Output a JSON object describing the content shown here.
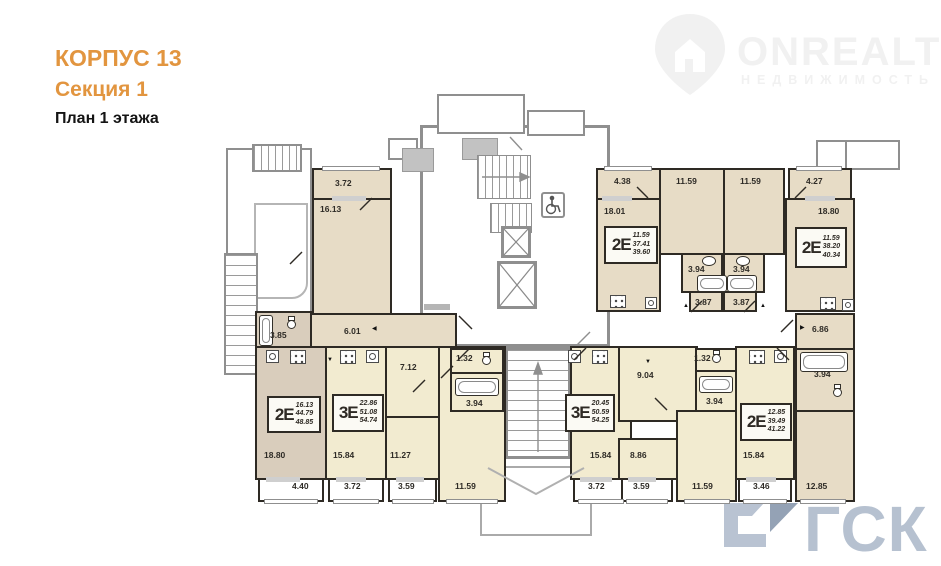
{
  "header": {
    "building": "КОРПУС 13",
    "section": "Секция 1",
    "plan": "План 1 этажа"
  },
  "watermarks": {
    "onrealt_name": "ONREALT",
    "onrealt_sub": "НЕДВИЖИМОСТЬ",
    "gsk": "ГСК"
  },
  "colors": {
    "title_accent": "#e2953f",
    "apartment_beige": "#e7dcc6",
    "apartment_taupe": "#d9cdbc",
    "apartment_cream": "#f2ebd0",
    "wall_dark": "#2e2a24",
    "wall_gray": "#8f8f8f",
    "gsk_watermark": "#b6c1d0"
  },
  "plan": {
    "apartments": [
      {
        "type": "2Е",
        "living": "11.59",
        "area": "37.41",
        "total": "39.60"
      },
      {
        "type": "2Е",
        "living": "11.59",
        "area": "38.20",
        "total": "40.34"
      },
      {
        "type": "2Е",
        "living": "16.13",
        "area": "44.79",
        "total": "48.85"
      },
      {
        "type": "3Е",
        "living": "22.86",
        "area": "51.08",
        "total": "54.74"
      },
      {
        "type": "3Е",
        "living": "20.45",
        "area": "50.59",
        "total": "54.25"
      },
      {
        "type": "2Е",
        "living": "12.85",
        "area": "39.49",
        "total": "41.22"
      }
    ],
    "areas": [
      {
        "room": "balcony",
        "value": "3.72"
      },
      {
        "room": "room",
        "value": "16.13"
      },
      {
        "room": "balcony",
        "value": "4.38"
      },
      {
        "room": "room",
        "value": "18.01"
      },
      {
        "room": "room",
        "value": "11.59"
      },
      {
        "room": "room",
        "value": "11.59"
      },
      {
        "room": "balcony",
        "value": "4.27"
      },
      {
        "room": "room",
        "value": "18.80"
      },
      {
        "room": "bath",
        "value": "3.94"
      },
      {
        "room": "bath",
        "value": "3.94"
      },
      {
        "room": "hall",
        "value": "3.87"
      },
      {
        "room": "hall",
        "value": "3.87"
      },
      {
        "room": "bath",
        "value": "3.85"
      },
      {
        "room": "hall",
        "value": "6.01"
      },
      {
        "room": "hall",
        "value": "6.86"
      },
      {
        "room": "hall",
        "value": "7.12"
      },
      {
        "room": "wc",
        "value": "1.32"
      },
      {
        "room": "bath",
        "value": "3.94"
      },
      {
        "room": "hall",
        "value": "9.04"
      },
      {
        "room": "wc",
        "value": "1.32"
      },
      {
        "room": "bath",
        "value": "3.94"
      },
      {
        "room": "bath",
        "value": "3.94"
      },
      {
        "room": "room",
        "value": "18.80"
      },
      {
        "room": "balcony",
        "value": "4.40"
      },
      {
        "room": "room",
        "value": "15.84"
      },
      {
        "room": "balcony",
        "value": "3.72"
      },
      {
        "room": "room",
        "value": "11.27"
      },
      {
        "room": "balcony",
        "value": "3.59"
      },
      {
        "room": "room",
        "value": "11.59"
      },
      {
        "room": "room",
        "value": "15.84"
      },
      {
        "room": "balcony",
        "value": "3.72"
      },
      {
        "room": "room",
        "value": "8.86"
      },
      {
        "room": "balcony",
        "value": "3.59"
      },
      {
        "room": "room",
        "value": "11.59"
      },
      {
        "room": "room",
        "value": "15.84"
      },
      {
        "room": "balcony",
        "value": "3.46"
      },
      {
        "room": "room",
        "value": "12.85"
      }
    ]
  }
}
